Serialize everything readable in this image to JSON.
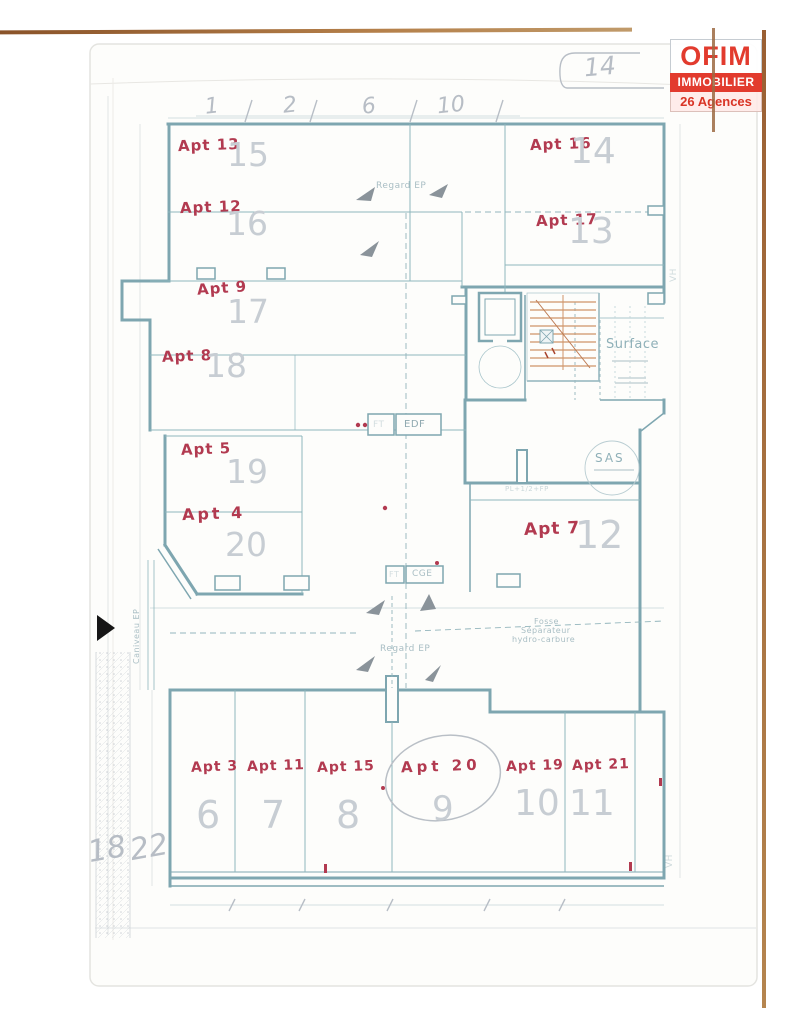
{
  "logo": {
    "name": "OFIM",
    "line2": "IMMOBILIER",
    "line3": "26 Agences"
  },
  "page_ref": "14",
  "top_dimensions": [
    "1",
    "2",
    "6",
    "10"
  ],
  "apartments": [
    {
      "label": "Apt 13",
      "room": "15"
    },
    {
      "label": "Apt 12",
      "room": "16"
    },
    {
      "label": "Apt 9",
      "room": "17"
    },
    {
      "label": "Apt 8",
      "room": "18"
    },
    {
      "label": "Apt 5",
      "room": "19"
    },
    {
      "label": "Apt 4",
      "room": "20"
    },
    {
      "label": "Apt 16",
      "room": "14"
    },
    {
      "label": "Apt 17",
      "room": "13"
    },
    {
      "label": "Apt 7",
      "room": "12"
    },
    {
      "label": "Apt 3",
      "room": "6"
    },
    {
      "label": "Apt 11",
      "room": "7"
    },
    {
      "label": "Apt 15",
      "room": "8"
    },
    {
      "label": "Apt 20",
      "room": "9"
    },
    {
      "label": "Apt 19",
      "room": "10"
    },
    {
      "label": "Apt 21",
      "room": "11"
    }
  ],
  "margin_numbers": {
    "left": "18",
    "right": "22"
  },
  "plan_labels": {
    "regard_ep_top": "Regard EP",
    "regard_ep_bottom": "Regard EP",
    "surface": "Surface",
    "sas": "SAS",
    "fosse_line1": "Fosse",
    "fosse_line2": "Séparateur",
    "fosse_line3": "hydro-carbure",
    "caniveau": "Caniveau EP",
    "edf": "EDF",
    "cge": "CGE",
    "ft_upper": "FT",
    "ft_lower": "FT",
    "pl_note": "PL+1/2+FP",
    "vh_right": "VH",
    "vh_bottom": "VH"
  },
  "colors": {
    "handwriting_red": "#b23a50",
    "pencil_gray": "#c7cdd3",
    "plan_teal": "#7ea6b0",
    "stair_orange": "#cf9468",
    "logo_red": "#e23b2e",
    "scan_edge_brown": "#a9713f"
  }
}
